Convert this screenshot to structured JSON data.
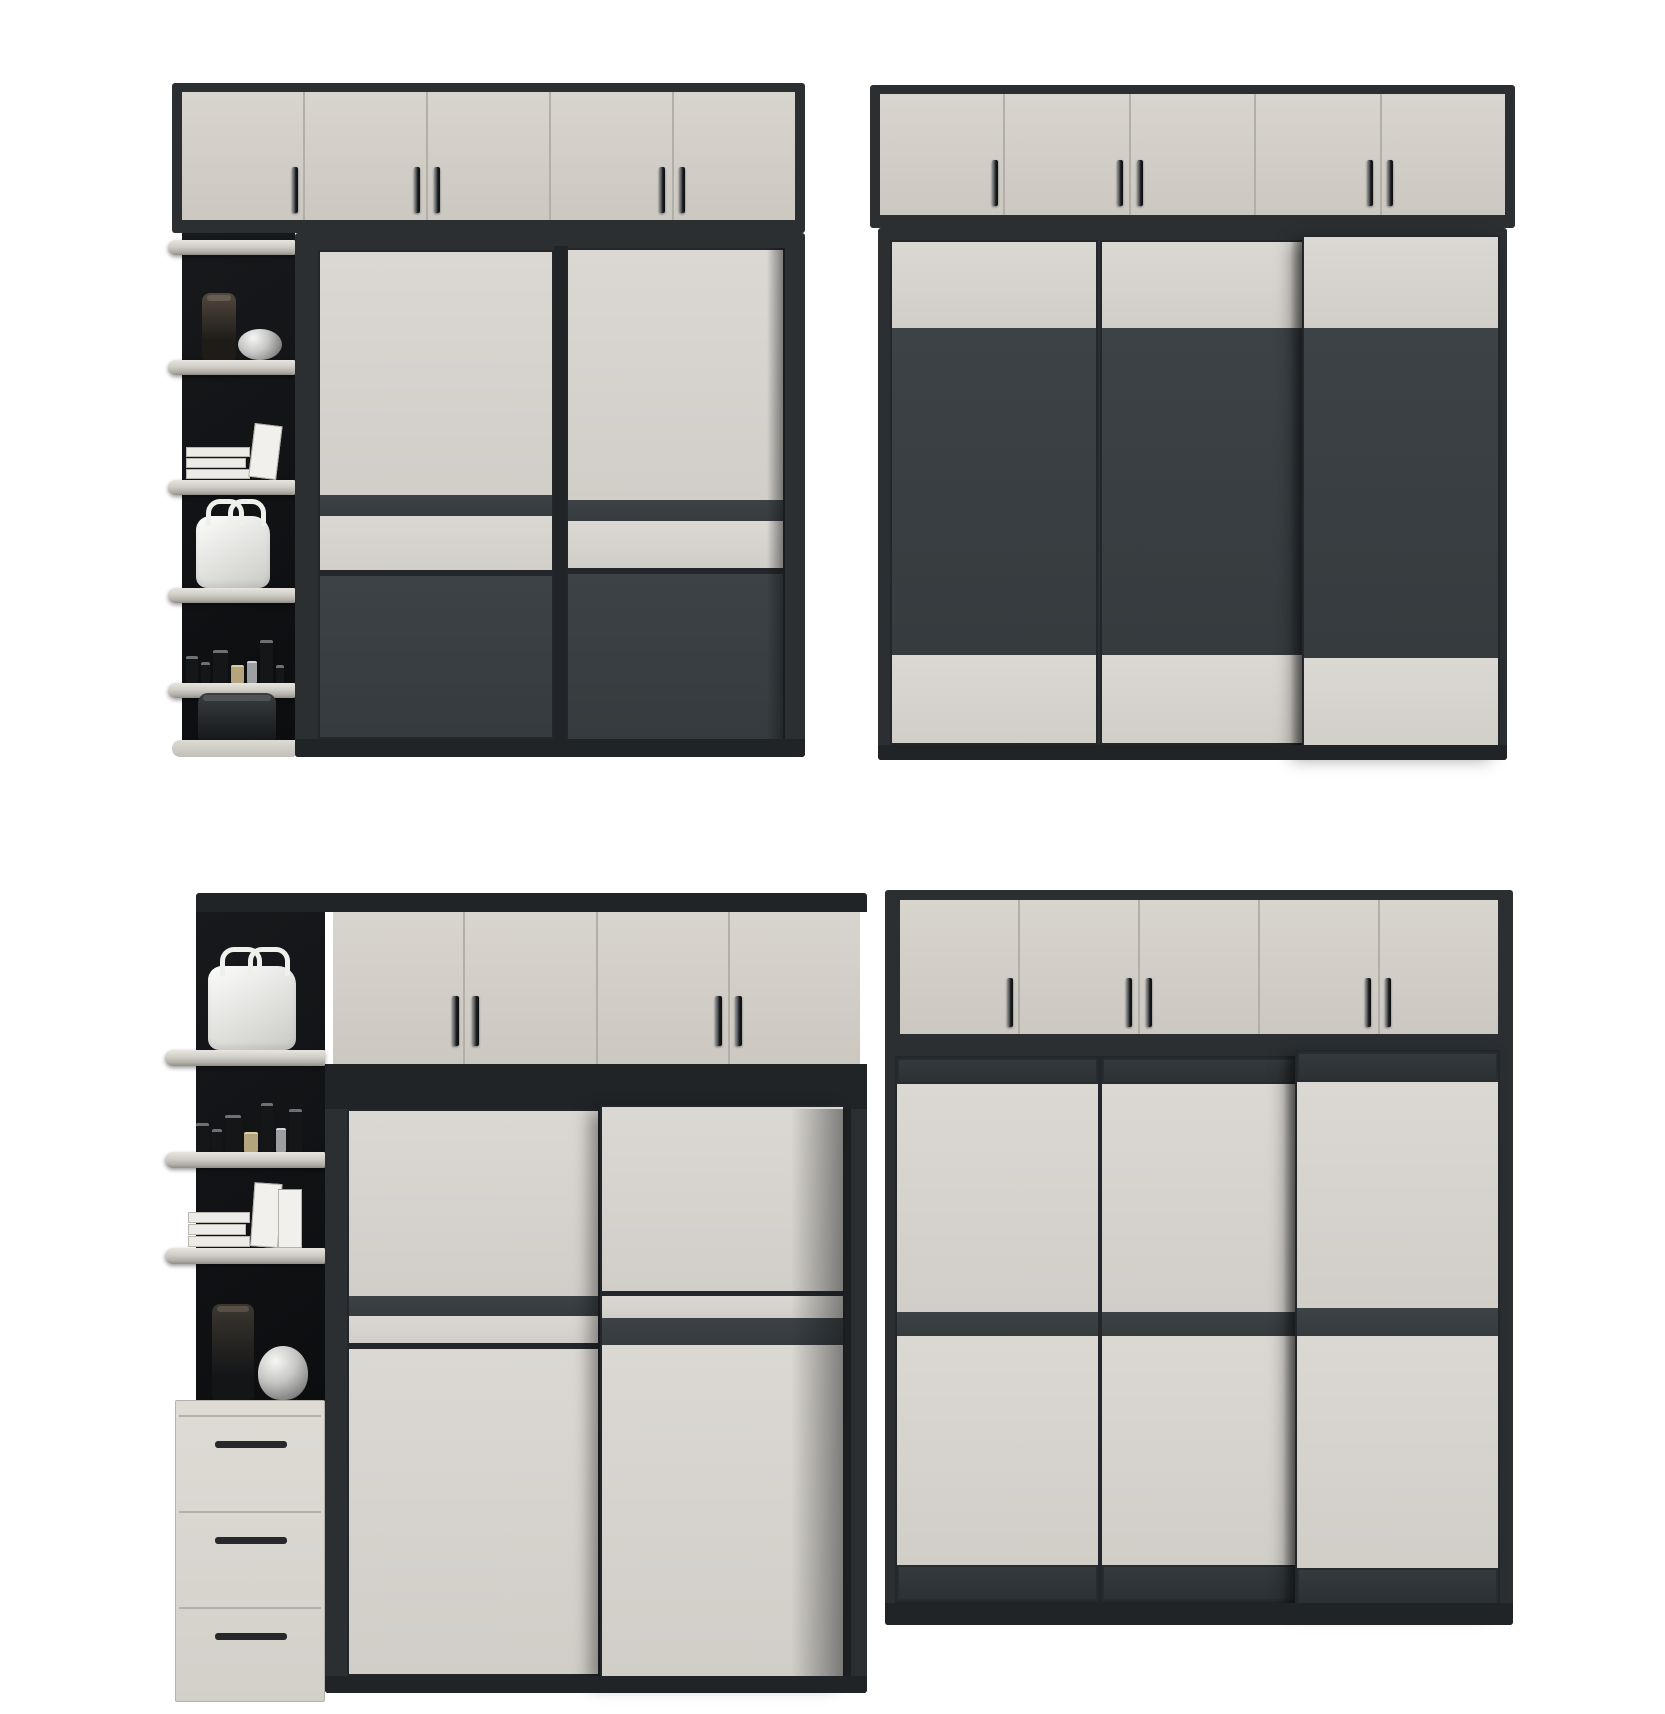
{
  "palette": {
    "frame": "#2b2f32",
    "frame_deep": "#202427",
    "cream_cab_hi": "#d8d4ce",
    "cream_cab_lo": "#ccc8c1",
    "cream_door": "#d7d4cf",
    "panel_dark": "#3a4043",
    "black_back": "#121417",
    "shelf_cream": "#d6d3cd",
    "divider": "#b2aea8",
    "handle_dark": "#17191b",
    "white_item": "#f2f2f0",
    "silver_item": "#c6c6c4",
    "background": "#ffffff"
  },
  "scene": {
    "description": "Product render of four modern wardrobe units in a 2x2 arrangement, cream and charcoal two-tone finish",
    "wardrobes": [
      {
        "position": "top-left",
        "top_cabinet_doors": 5,
        "top_cabinet_handles": "one single and two pairs",
        "main_sliding_doors": 2,
        "door_style": "large cream upper panel, dark band, cream strip, dark grey lower panel",
        "side_unit": "open corner shelf column",
        "shelf_decor": [
          "dark glass vase",
          "silver ornament",
          "magazine stack",
          "leaning book",
          "white handbag",
          "cosmetic bottles",
          "black round box"
        ]
      },
      {
        "position": "top-right",
        "top_cabinet_doors": 5,
        "top_cabinet_handles": "one single and two pairs",
        "main_sliding_doors": 3,
        "door_style": "cream top strip, large dark grey centre panel, cream bottom strip",
        "side_unit": "none",
        "shelf_decor": []
      },
      {
        "position": "bottom-left",
        "top_cabinet_doors": 4,
        "top_cabinet_handles": "two pairs",
        "main_sliding_doors": 2,
        "door_style": "cream panels with narrow dark accent bands",
        "side_unit": "open corner shelf column with three-drawer chest",
        "shelf_decor": [
          "white handbag",
          "cosmetic bottles",
          "magazine stack",
          "books",
          "black cylinder vase",
          "silver vase"
        ],
        "drawers": 3
      },
      {
        "position": "bottom-right",
        "top_cabinet_doors": 5,
        "top_cabinet_handles": "one single and two pairs",
        "main_sliding_doors": 3,
        "door_style": "cream panels with dark header, middle and footer bands",
        "side_unit": "none",
        "shelf_decor": []
      }
    ]
  }
}
